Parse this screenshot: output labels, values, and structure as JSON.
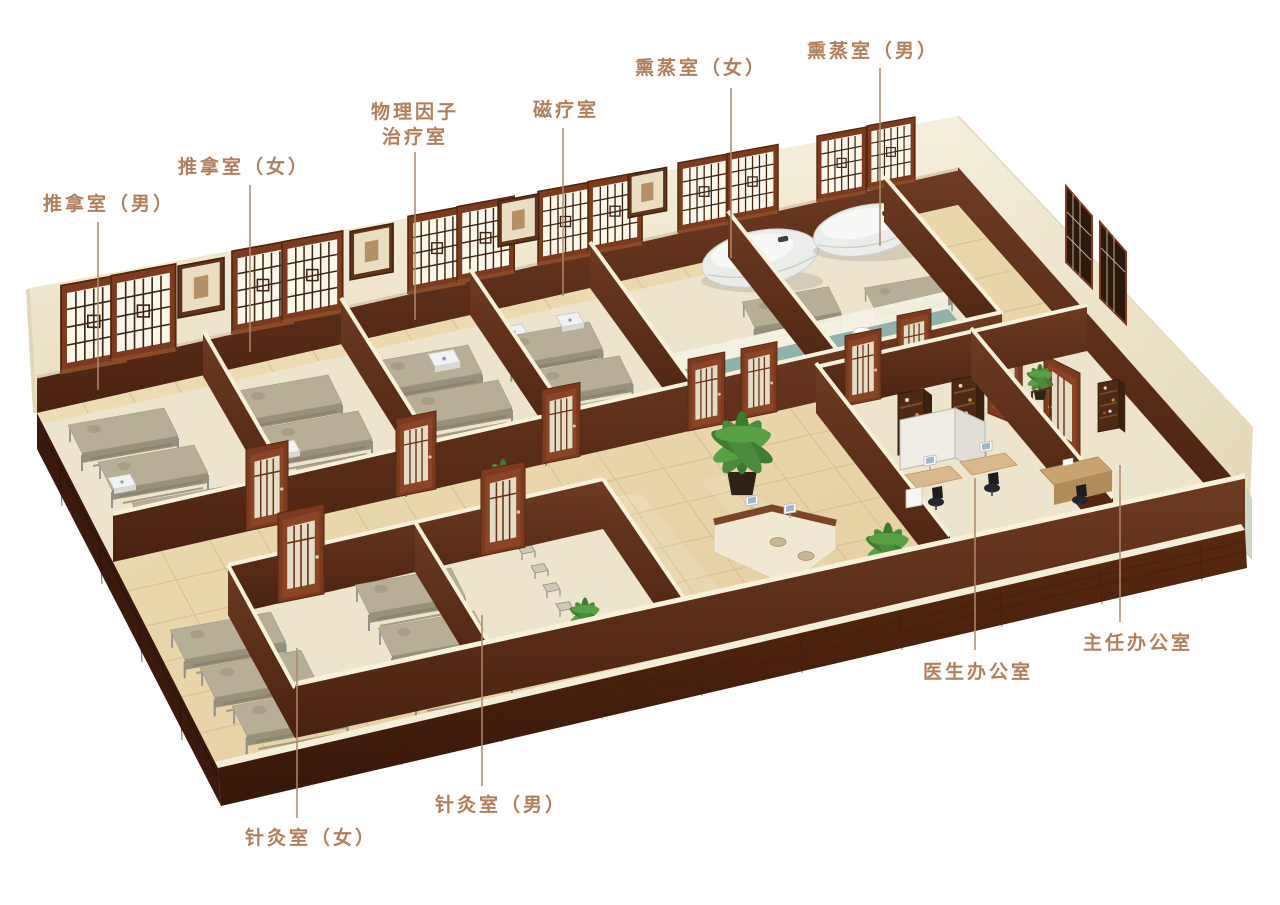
{
  "scene": {
    "description": "3D cutaway floor-plan rendering of a traditional Chinese medicine therapy department",
    "view": "isometric cutaway, white background, rooms annotated with leader lines"
  },
  "rooms": {
    "massage_male": {
      "label": "推拿室（男）"
    },
    "massage_female": {
      "label": "推拿室（女）"
    },
    "physical_factor_therapy": {
      "label_line1": "物理因子",
      "label_line2": "治疗室"
    },
    "magnetic_therapy": {
      "label": "磁疗室"
    },
    "fumigation_female": {
      "label": "熏蒸室（女）"
    },
    "fumigation_male": {
      "label": "熏蒸室（男）"
    },
    "acupuncture_female": {
      "label": "针灸室（女）"
    },
    "acupuncture_male": {
      "label": "针灸室（男）"
    },
    "doctor_office": {
      "label": "医生办公室"
    },
    "director_office": {
      "label": "主任办公室"
    }
  },
  "colors": {
    "background": "#ffffff",
    "label_text": "#b27f5b",
    "leader_line": "#ad8a68",
    "wall_cream": "#f2ecd7",
    "wood_mahogany": "#5a2c1b",
    "floor_tile": "#e8d5a9",
    "room_floor": "#ece4cd",
    "bathroom_teal": "#8fb3ab",
    "plant_green": "#4c8a3c",
    "bed_top": "#b7ae97",
    "capsule_white": "#f0f1ee"
  }
}
